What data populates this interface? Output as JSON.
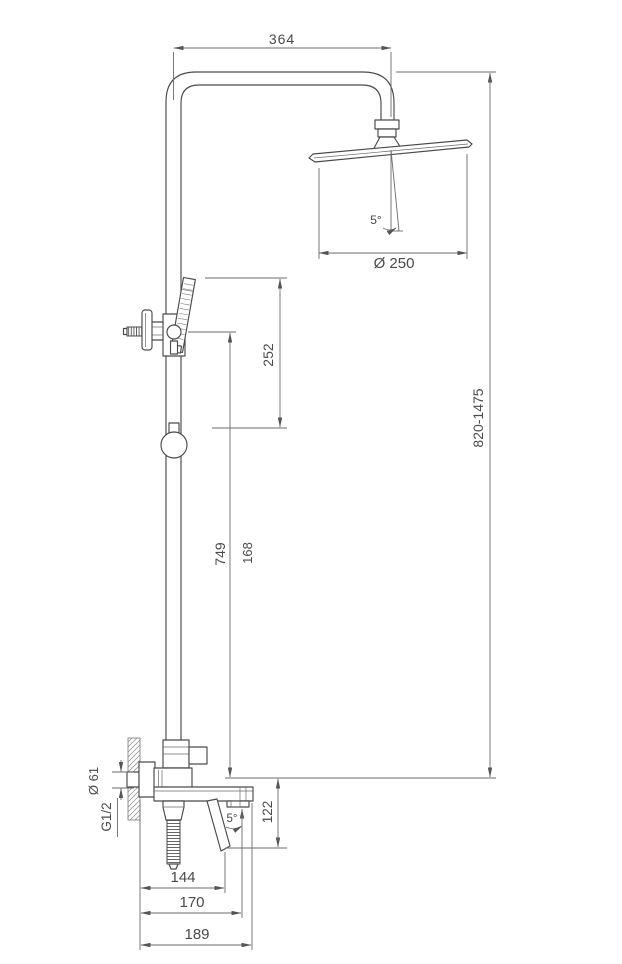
{
  "drawing": {
    "kind": "shower-system-technical-drawing",
    "background": "#ffffff",
    "product_line_color": "#4a4a4a",
    "dimension_line_color": "#6b6b6b",
    "text_color": "#4a4a4a",
    "dims": {
      "top_width": "364",
      "head_diameter": "Ø 250",
      "head_tilt": "5°",
      "handshower_span": "252",
      "riser_length": "749",
      "slider_span": "168",
      "height_range": "820-1475",
      "flange_diameter": "Ø 61",
      "thread_size": "G1/2",
      "spout_drop": "122",
      "spout_tilt": "5°",
      "reach_handle": "144",
      "reach_aerator": "170",
      "reach_spout": "189"
    }
  }
}
